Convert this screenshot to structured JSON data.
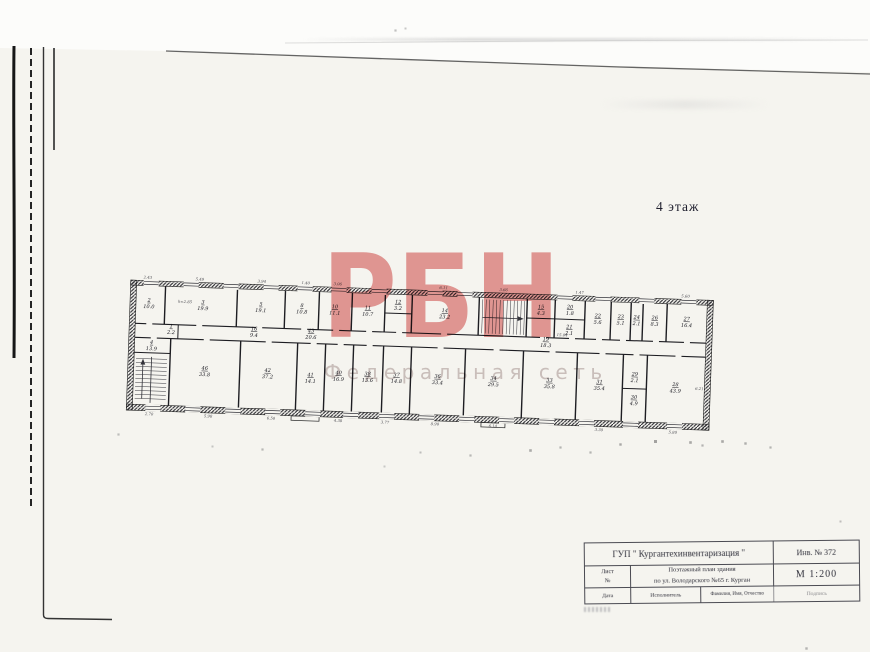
{
  "page": {
    "floor_label": "4 этаж"
  },
  "watermark": {
    "letters": "РБН",
    "tagline": "Федеральная сеть",
    "letters_color": "#e2807f",
    "tagline_color": "#cdc1c1"
  },
  "plan": {
    "rooms": [
      {
        "no": "2",
        "area": "10.0",
        "x": 22,
        "y": 27
      },
      {
        "no": "3",
        "area": "19.9",
        "x": 76,
        "y": 27
      },
      {
        "no": "5",
        "area": "19.1",
        "x": 134,
        "y": 27
      },
      {
        "no": "8",
        "area": "10.8",
        "x": 175,
        "y": 27
      },
      {
        "no": "10",
        "area": "11.1",
        "x": 208,
        "y": 27
      },
      {
        "no": "11",
        "area": "10.7",
        "x": 241,
        "y": 27
      },
      {
        "no": "12",
        "area": "3.2",
        "x": 271,
        "y": 20
      },
      {
        "no": "14",
        "area": "23.2",
        "x": 318,
        "y": 27
      },
      {
        "no": "15",
        "area": "4.3",
        "x": 414,
        "y": 20
      },
      {
        "no": "20",
        "area": "1.8",
        "x": 443,
        "y": 19
      },
      {
        "no": "21",
        "area": "2.1",
        "x": 443,
        "y": 39
      },
      {
        "no": "22",
        "area": "5.6",
        "x": 471,
        "y": 27
      },
      {
        "no": "23",
        "area": "5.1",
        "x": 494,
        "y": 27
      },
      {
        "no": "24",
        "area": "2.1",
        "x": 510,
        "y": 27
      },
      {
        "no": "26",
        "area": "8.3",
        "x": 528,
        "y": 27
      },
      {
        "no": "27",
        "area": "16.4",
        "x": 560,
        "y": 27
      },
      {
        "no": "1",
        "area": "2.2",
        "x": 45,
        "y": 52
      },
      {
        "no": "16",
        "area": "9.4",
        "x": 128,
        "y": 52
      },
      {
        "no": "43",
        "area": "20.6",
        "x": 185,
        "y": 52
      },
      {
        "no": "19",
        "area": "18.3",
        "x": 420,
        "y": 52
      },
      {
        "no": "4",
        "area": "13.9",
        "x": 26,
        "y": 69
      },
      {
        "no": "46",
        "area": "33.8",
        "x": 80,
        "y": 93
      },
      {
        "no": "42",
        "area": "37.2",
        "x": 143,
        "y": 93
      },
      {
        "no": "41",
        "area": "14.1",
        "x": 186,
        "y": 96
      },
      {
        "no": "40",
        "area": "16.9",
        "x": 214,
        "y": 93
      },
      {
        "no": "38",
        "area": "13.6",
        "x": 243,
        "y": 93
      },
      {
        "no": "37",
        "area": "14.8",
        "x": 272,
        "y": 93
      },
      {
        "no": "36",
        "area": "33.4",
        "x": 313,
        "y": 93
      },
      {
        "no": "34",
        "area": "29.5",
        "x": 369,
        "y": 93
      },
      {
        "no": "33",
        "area": "35.8",
        "x": 425,
        "y": 93
      },
      {
        "no": "31",
        "area": "35.4",
        "x": 475,
        "y": 93
      },
      {
        "no": "29",
        "area": "2.1",
        "x": 510,
        "y": 84
      },
      {
        "no": "30",
        "area": "4.9",
        "x": 510,
        "y": 107
      },
      {
        "no": "28",
        "area": "43.9",
        "x": 551,
        "y": 93
      }
    ],
    "annotations": [
      {
        "t": "2.43",
        "x": 20,
        "y": 4
      },
      {
        "t": "5.49",
        "x": 72,
        "y": 4
      },
      {
        "t": "3.94",
        "x": 134,
        "y": 4
      },
      {
        "t": "1.40",
        "x": 178,
        "y": 4
      },
      {
        "t": "3.06",
        "x": 210,
        "y": 4
      },
      {
        "t": "6.11",
        "x": 316,
        "y": 4
      },
      {
        "t": "3.66",
        "x": 376,
        "y": 4
      },
      {
        "t": "1.47",
        "x": 452,
        "y": 4
      },
      {
        "t": "5.60",
        "x": 558,
        "y": 4
      },
      {
        "t": "h=2.85",
        "x": 58,
        "y": 27
      },
      {
        "t": "15.04",
        "x": 436,
        "y": 47
      },
      {
        "t": "2.70",
        "x": 26,
        "y": 140.5
      },
      {
        "t": "5.98",
        "x": 85,
        "y": 140.5
      },
      {
        "t": "6.50",
        "x": 148,
        "y": 140.5
      },
      {
        "t": "4.38",
        "x": 215,
        "y": 140.5
      },
      {
        "t": "3.77",
        "x": 262,
        "y": 140.5
      },
      {
        "t": "8.90",
        "x": 312,
        "y": 140.5
      },
      {
        "t": "6.14",
        "x": 370,
        "y": 140.5
      },
      {
        "t": "3.30",
        "x": 476,
        "y": 140.5
      },
      {
        "t": "5.80",
        "x": 550,
        "y": 140.5
      },
      {
        "t": "6.21",
        "x": 575,
        "y": 96
      }
    ]
  },
  "title_block": {
    "org": "ГУП \" Кургантехинвентаризация \"",
    "inventory_no": "Инв. № 372",
    "sheet_col_line1": "Лист",
    "sheet_col_line2": "№",
    "doc_title_line1": "Поэтажный план здания",
    "doc_title_line2": "по ул. Володарского №65  г. Курган",
    "scale": "М 1:200",
    "date_label": "Дата",
    "executor_label": "Исполнитель",
    "fullname_label": "Фамилия, Имя, Отчество",
    "signature_label": "Подпись"
  }
}
